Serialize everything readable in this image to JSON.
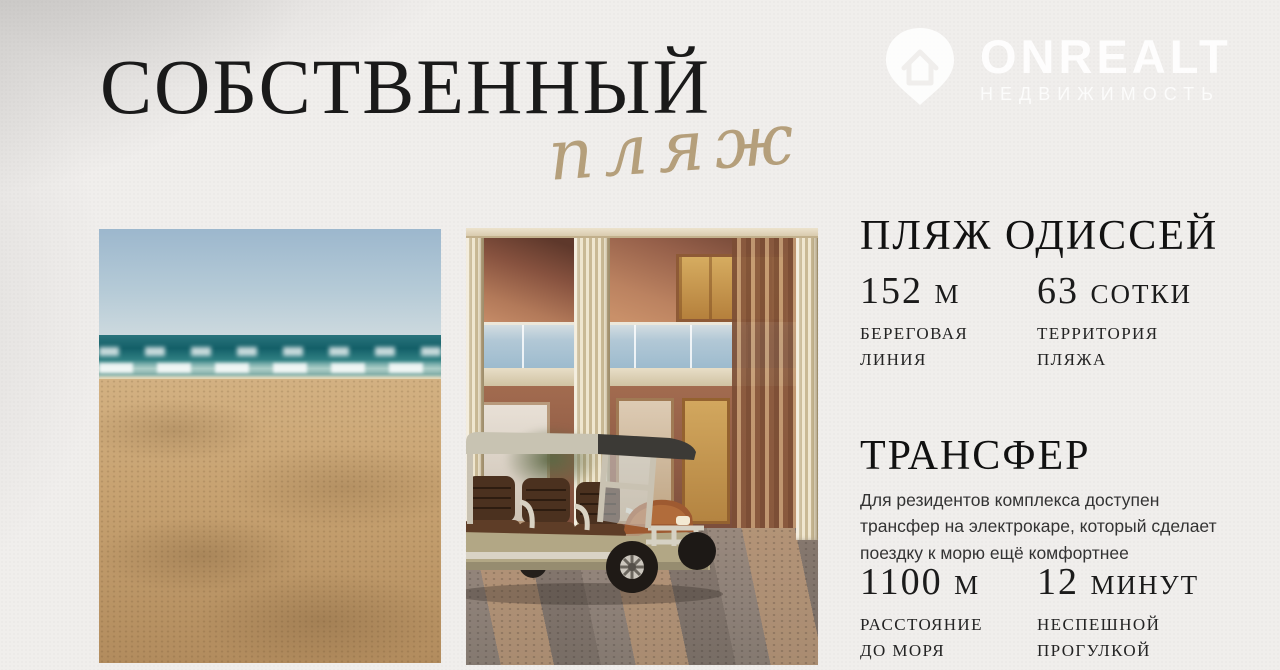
{
  "slide": {
    "title": "СОБСТВЕННЫЙ",
    "script_word": "пляж",
    "background_color": "#f0eeec",
    "accent_gold": "#ab9268",
    "text_color": "#1a1a1a"
  },
  "watermark": {
    "brand": "ONREALT",
    "subtitle": "НЕДВИЖИМОСТЬ",
    "icon": "house-pin-icon",
    "color": "rgba(255,255,255,0.88)"
  },
  "sections": [
    {
      "heading": "ПЛЯЖ ОДИССЕЙ",
      "stats": [
        {
          "value": "152 м",
          "label": "БЕРЕГОВАЯ\nЛИНИЯ"
        },
        {
          "value": "63 сотки",
          "label": "ТЕРРИТОРИЯ\nПЛЯЖА"
        }
      ]
    },
    {
      "heading": "ТРАНСФЕР",
      "description": "Для резидентов комплекса доступен трансфер на электрокаре, который сделает поездку к морю ещё комфортнее",
      "stats": [
        {
          "value": "1100 м",
          "label": "РАССТОЯНИЕ\nДО МОРЯ"
        },
        {
          "value": "12 минут",
          "label": "НЕСПЕШНОЙ\nПРОГУЛКОЙ"
        }
      ]
    }
  ]
}
